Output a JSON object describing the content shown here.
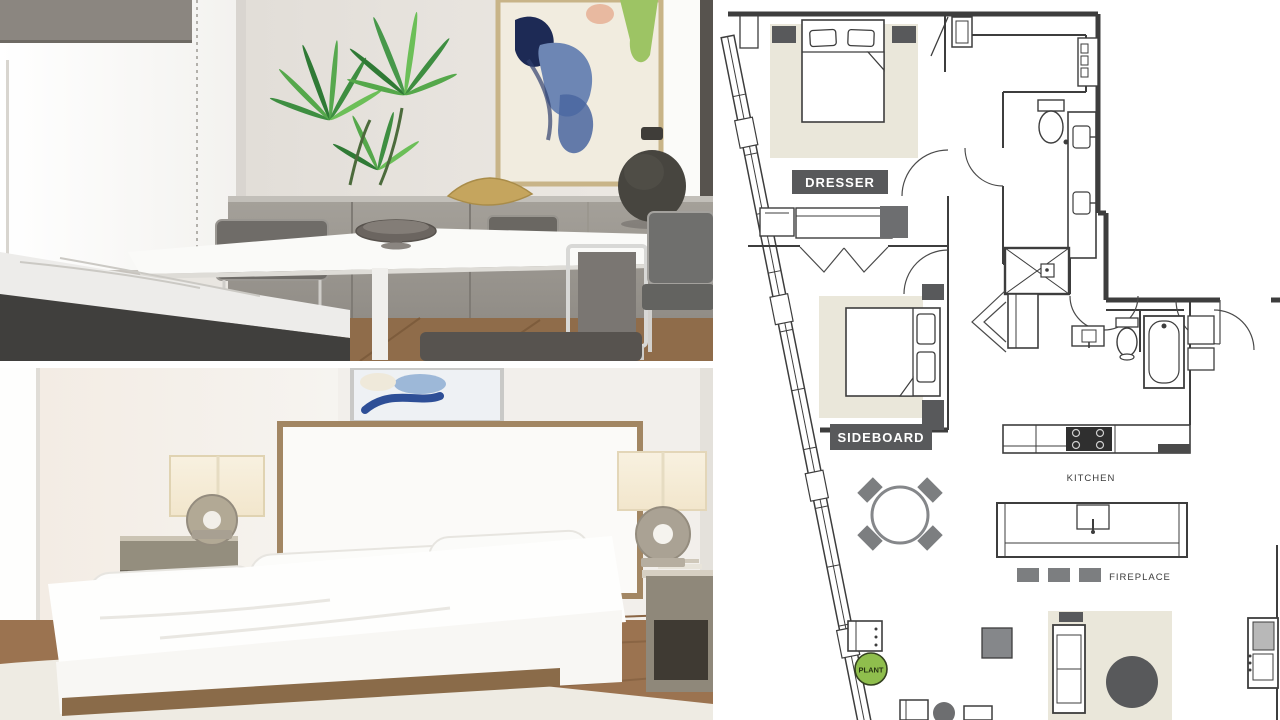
{
  "collage": {
    "panels": [
      {
        "name": "dining-room-photo",
        "type": "photo"
      },
      {
        "name": "bedroom-photo",
        "type": "photo"
      },
      {
        "name": "floor-plan",
        "type": "plan"
      }
    ]
  },
  "floor_plan": {
    "labels": {
      "dresser": "DRESSER",
      "sideboard": "SIDEBOARD",
      "kitchen": "KITCHEN",
      "fireplace": "FIREPLACE",
      "plant": "PLANT"
    },
    "colors": {
      "label_background": "#58595b",
      "label_text": "#ffffff",
      "rug": "#eae7da",
      "furniture_gray": "#7c7e80",
      "dark_gray": "#58595b",
      "plant_green": "#8fbe4d",
      "line": "#3d3d3d",
      "background": "#ffffff"
    }
  }
}
